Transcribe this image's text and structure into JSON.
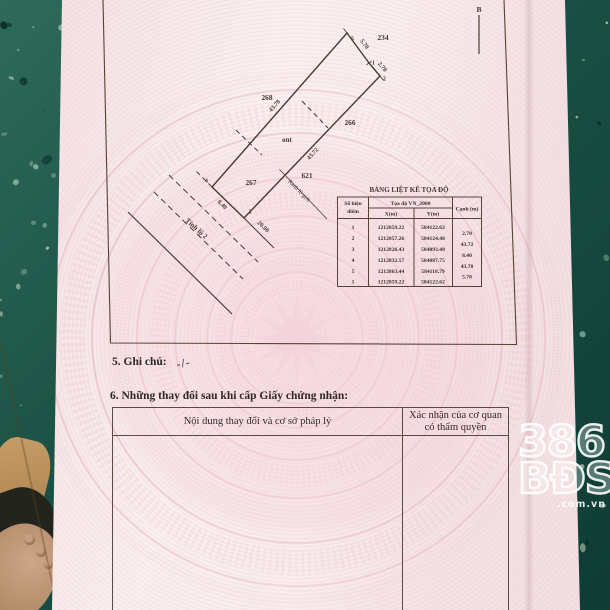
{
  "colors": {
    "paper_pink": "#f6e4e6",
    "floor_teal": "#1d5347",
    "ink": "#463a30",
    "watermark_pink": "#e4aebc",
    "logo_white": "#ffffff"
  },
  "map": {
    "north_label": "B",
    "land_use_code": "ont",
    "road_name": "Tỉnh lộ 2",
    "boundary_label": "Ranh lộ giới",
    "parcels": {
      "p234": "234",
      "p268": "268",
      "p266": "266",
      "p267": "267",
      "p621": "621"
    },
    "points": {
      "p1": "1",
      "p2": "2",
      "p3": "3",
      "p4": "4",
      "p5": "5"
    },
    "dims": {
      "d12": "2.70",
      "d23": "43.72",
      "d34": "8.40",
      "d45": "43.78",
      "d51": "5.70",
      "ext": "20.00"
    }
  },
  "coord_table": {
    "title": "BẢNG LIỆT KÊ TỌA ĐỘ",
    "col_point_1": "Số hiệu",
    "col_point_2": "điểm",
    "col_coord": "Tọa độ VN_2000",
    "col_x": "X(m)",
    "col_y": "Y(m)",
    "col_edge": "Cạnh (m)",
    "rows": [
      {
        "point": "1",
        "x": "1212859.22",
        "y": "584122.62"
      },
      {
        "point": "2",
        "x": "1212857.26",
        "y": "584124.48"
      },
      {
        "point": "3",
        "x": "1212826.43",
        "y": "584093.48"
      },
      {
        "point": "4",
        "x": "1212832.57",
        "y": "584087.75"
      },
      {
        "point": "5",
        "x": "1212863.44",
        "y": "584118.79"
      },
      {
        "point": "1",
        "x": "1212859.22",
        "y": "584122.62"
      }
    ],
    "edges": [
      "2.70",
      "43.72",
      "8.40",
      "43.78",
      "5.70"
    ]
  },
  "sections": {
    "note_label": "5. Ghi chú:",
    "note_value": "-/-",
    "changes_label": "6. Những thay đổi sau khi cấp Giấy chứng nhận:",
    "changes_col1": "Nội dung thay đổi và cơ sở pháp lý",
    "changes_col2": "Xác nhận của cơ quan có thẩm quyền"
  },
  "watermark_logo": {
    "line1": "386",
    "line2": "BĐS",
    "line3": ".com.vn"
  }
}
